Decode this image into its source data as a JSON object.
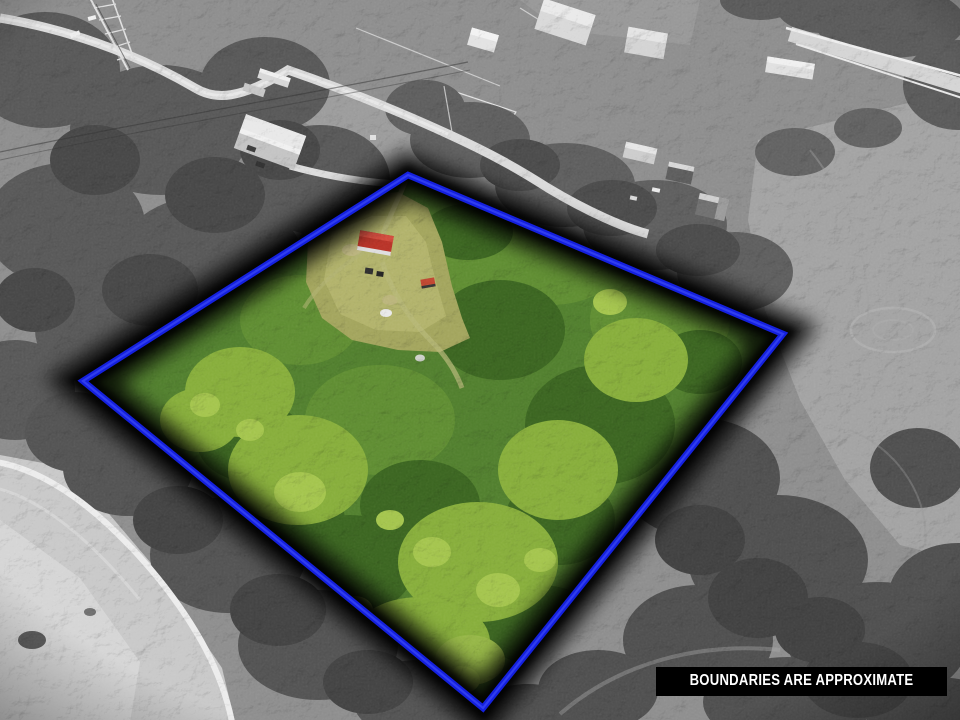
{
  "overlay": {
    "disclaimer": "BOUNDARIES ARE APPROXIMATE",
    "disclaimer_bg": "#000000",
    "disclaimer_fg": "#ffffff",
    "boundary_color": "#1420de",
    "boundary_core_color": "#3340f2",
    "boundary_glow_color": "#000000"
  }
}
